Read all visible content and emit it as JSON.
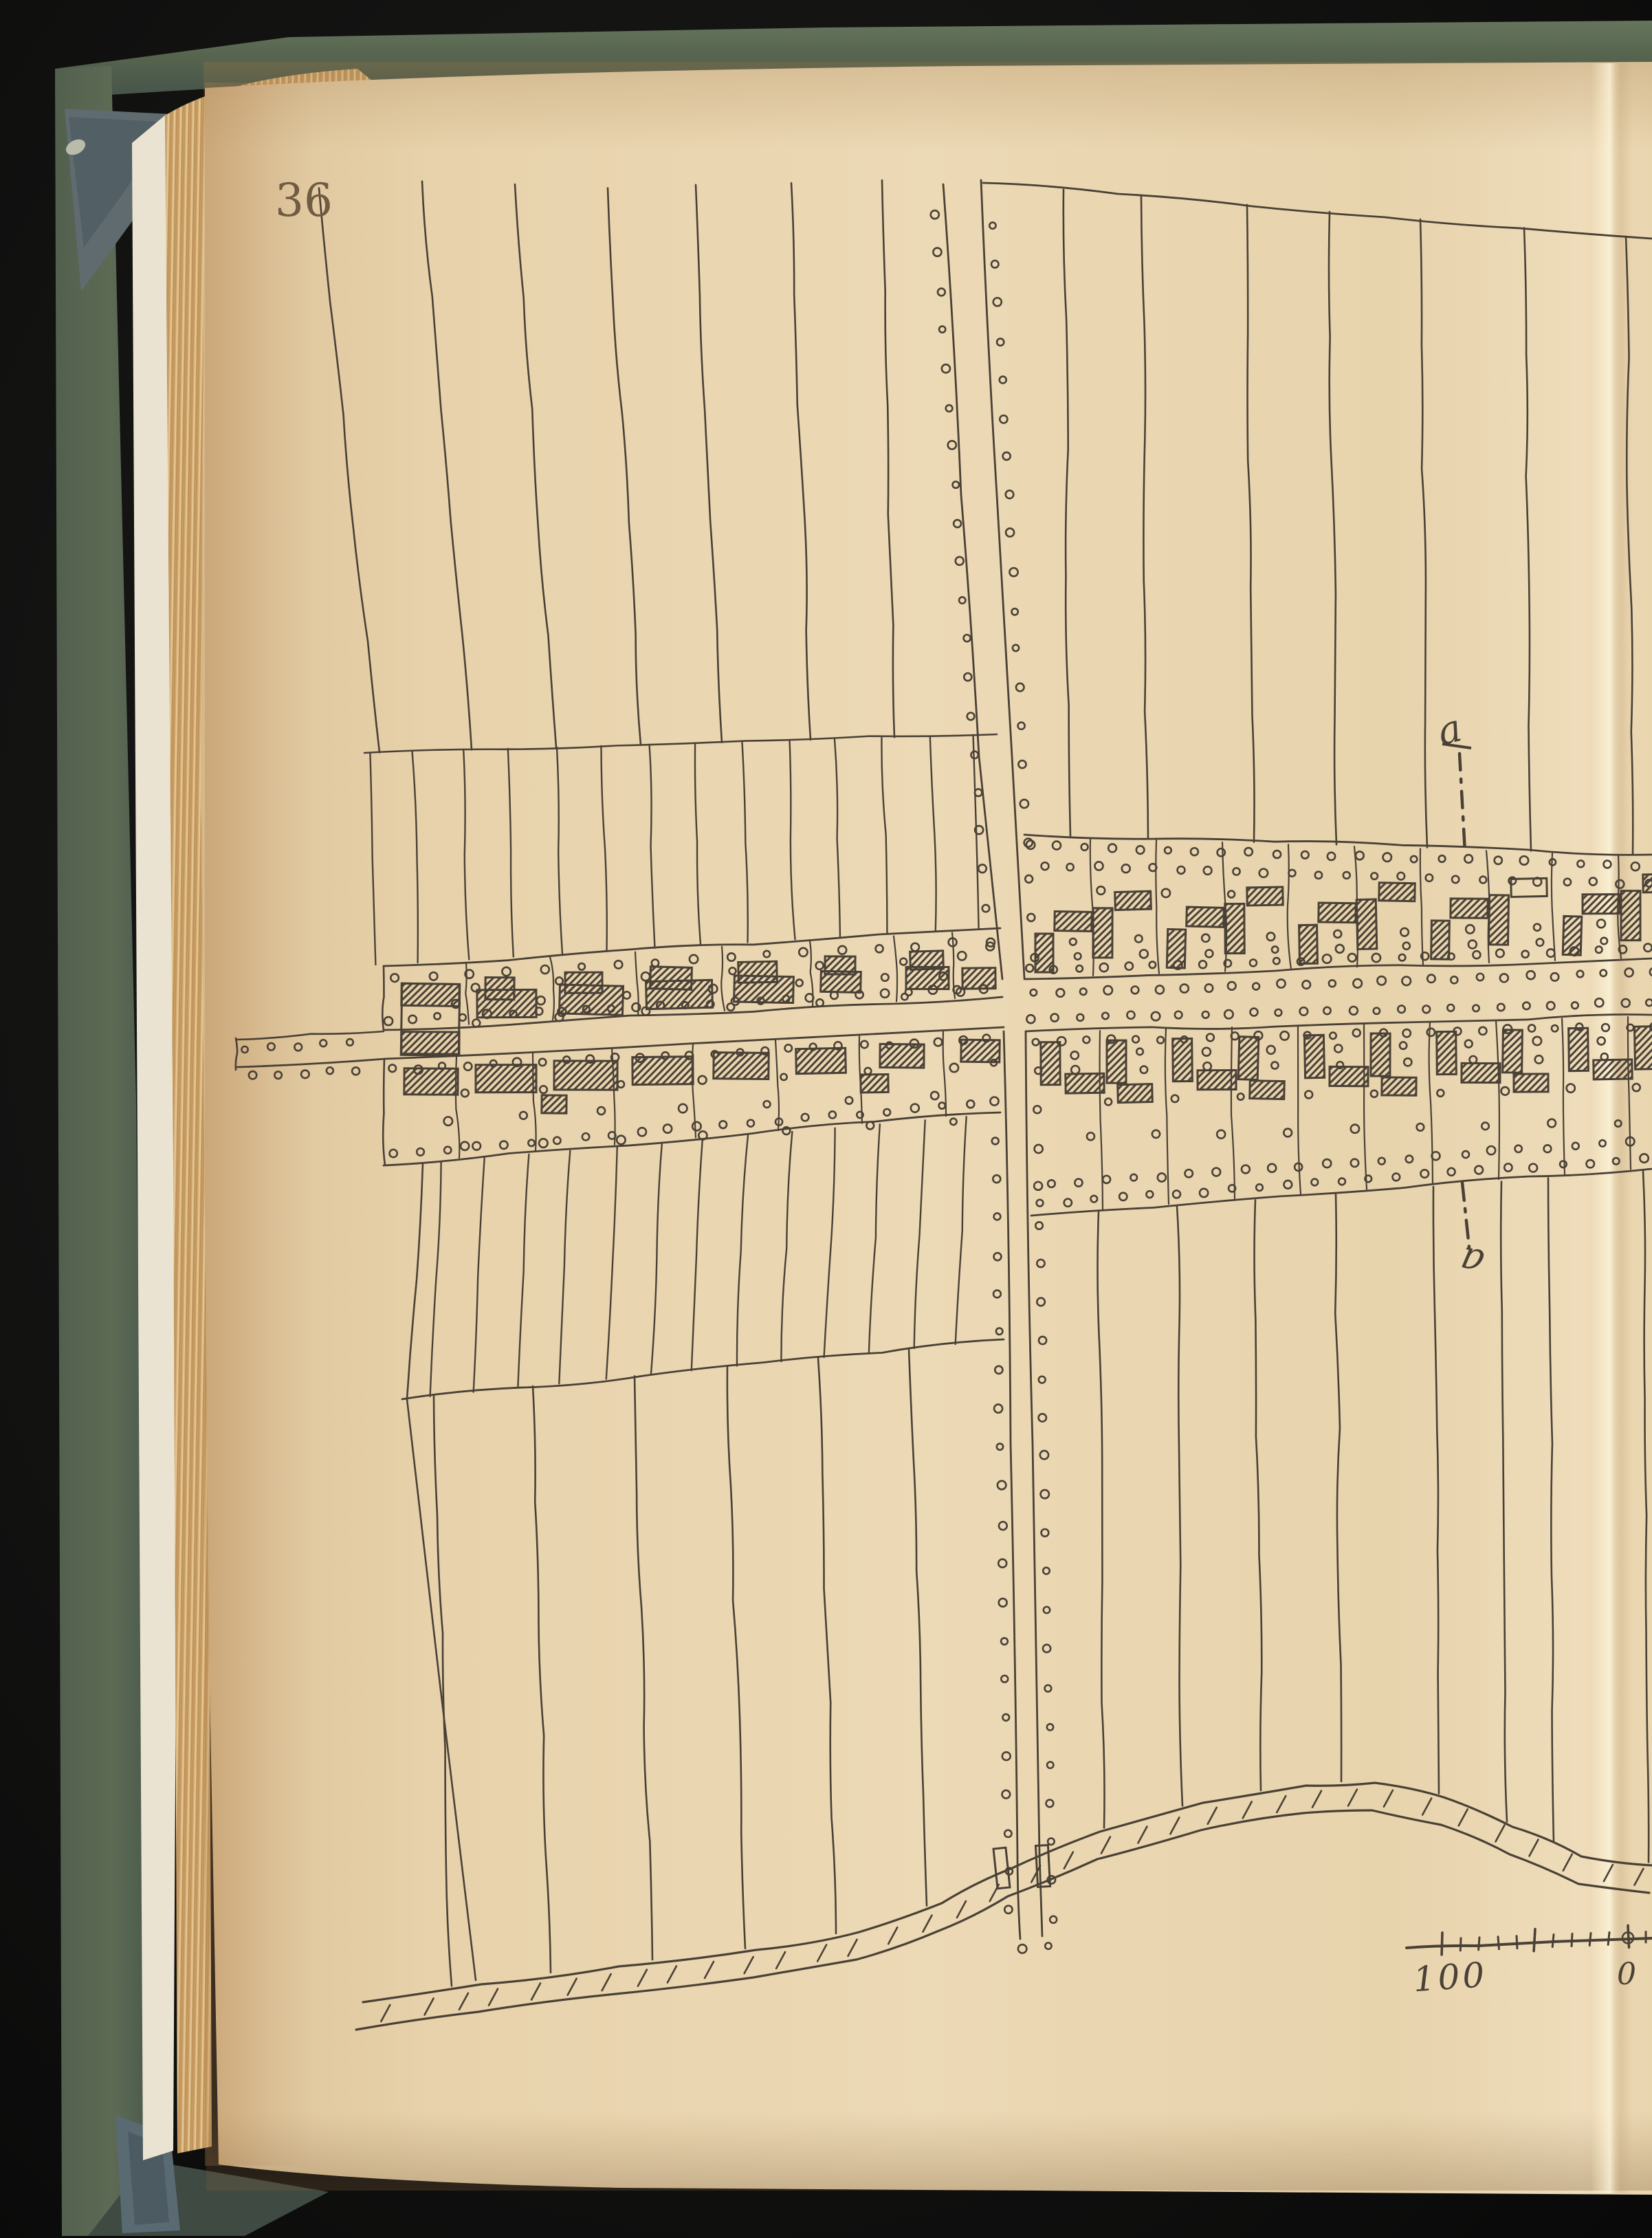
{
  "page": {
    "number": "36"
  },
  "drawing": {
    "section_line": {
      "top_label": "a",
      "bottom_label": "a"
    },
    "scale_bar": {
      "left_label": "100",
      "zero_label": "0"
    }
  },
  "colors": {
    "ink": "#4a4136",
    "page_number_ink": "#6f5c41",
    "paper": "#e9d5ae",
    "paper_edge": "#d2a96f",
    "cover_green": "#5c6a55",
    "cover_green_dark": "#47544a",
    "fray_cloth": "#5f6b6f",
    "background": "#111111"
  }
}
